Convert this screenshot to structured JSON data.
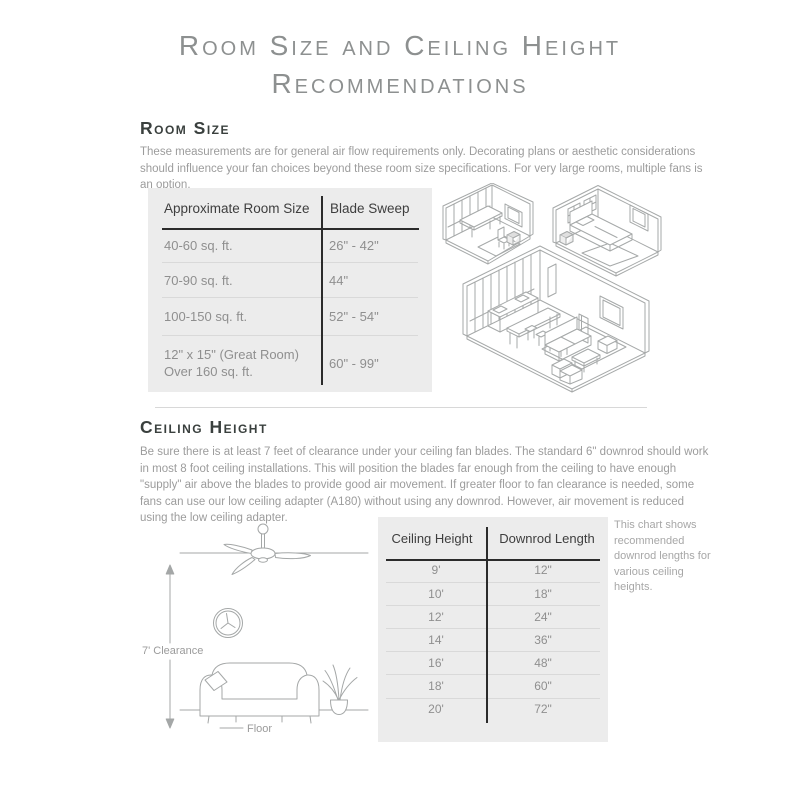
{
  "title": {
    "line1": "Room Size and Ceiling Height",
    "line2": "Recommendations"
  },
  "room_size": {
    "heading": "Room Size",
    "description": "These measurements are for general air flow requirements only. Decorating plans or aesthetic considerations should influence your fan choices beyond these room size specifications. For very large rooms, multiple fans is an option.",
    "table": {
      "headers": [
        "Approximate Room Size",
        "Blade Sweep"
      ],
      "rows": [
        [
          "40-60 sq. ft.",
          "26\" - 42\""
        ],
        [
          "70-90 sq. ft.",
          "44\""
        ],
        [
          "100-150 sq. ft.",
          "52\" - 54\""
        ],
        [
          "12\" x 15\" (Great Room)\nOver 160 sq. ft.",
          "60\" - 99\""
        ]
      ]
    }
  },
  "ceiling_height": {
    "heading": "Ceiling Height",
    "description": "Be sure there is at least 7 feet of clearance under your ceiling fan blades. The standard 6\" downrod should work in most 8 foot ceiling installations. This will position the blades far enough from the ceiling to have enough \"supply\" air above the blades to provide good air movement. If greater floor to fan clearance is needed, some fans can use our low ceiling adapter (A180) without using any downrod. However, air movement is reduced using the low ceiling adapter.",
    "table": {
      "headers": [
        "Ceiling Height",
        "Downrod Length"
      ],
      "rows": [
        [
          "9'",
          "12\""
        ],
        [
          "10'",
          "18\""
        ],
        [
          "12'",
          "24\""
        ],
        [
          "14'",
          "36\""
        ],
        [
          "16'",
          "48\""
        ],
        [
          "18'",
          "60\""
        ],
        [
          "20'",
          "72\""
        ]
      ]
    },
    "note": "This chart shows recommended downrod lengths for various ceiling heights.",
    "diagram_labels": {
      "clearance": "7' Clearance",
      "floor": "Floor"
    }
  },
  "colors": {
    "table_bg": "#ececec",
    "rule_dark": "#2b2b2b",
    "text_muted": "#9c9c9c",
    "line_art": "#a6a9a9"
  }
}
